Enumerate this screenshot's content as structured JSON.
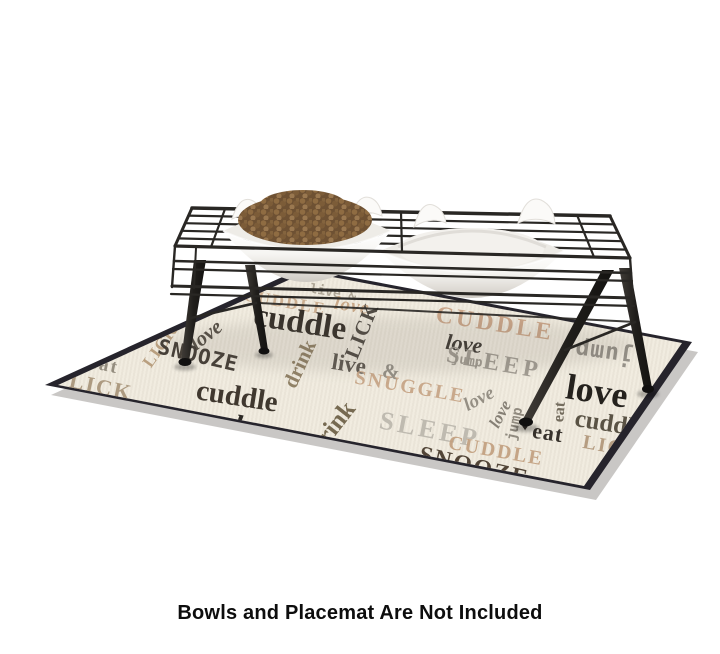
{
  "caption": "Bowls and Placemat Are Not Included",
  "stand": {
    "color": "#292724"
  },
  "bowls": {
    "color": "#f6f5f2",
    "kibble_color": "#7a5a38",
    "left_has_food": true,
    "right_empty": true
  },
  "mat": {
    "background": "#f1ece0",
    "border_color": "#26242c",
    "words": [
      {
        "t": "CUDDLE",
        "x": 285,
        "y": 302,
        "s": 17,
        "r": 10,
        "c": "#c9ab8b",
        "f": "serif",
        "ls": 2
      },
      {
        "t": "live &",
        "x": 333,
        "y": 293,
        "s": 13,
        "r": 10,
        "c": "#aaa292",
        "f": "mono",
        "ls": 0
      },
      {
        "t": "love",
        "x": 352,
        "y": 306,
        "s": 19,
        "r": 9,
        "c": "#c6a584",
        "f": "serif",
        "i": true,
        "ls": 1
      },
      {
        "t": "CUDDLE",
        "x": 495,
        "y": 324,
        "s": 24,
        "r": 9,
        "c": "#c9a284",
        "f": "serif",
        "ls": 3
      },
      {
        "t": "love",
        "x": 464,
        "y": 344,
        "s": 22,
        "r": 7,
        "c": "#35302a",
        "f": "serif",
        "i": true
      },
      {
        "t": "jump",
        "x": 467,
        "y": 361,
        "s": 13,
        "r": 9,
        "c": "#9c968c",
        "f": "mono"
      },
      {
        "t": "LICK",
        "x": 362,
        "y": 331,
        "s": 21,
        "r": -68,
        "c": "#46413a",
        "f": "serif",
        "ls": 1
      },
      {
        "t": "cuddle",
        "x": 300,
        "y": 323,
        "s": 33,
        "r": 9,
        "c": "#29231d",
        "f": "serif"
      },
      {
        "t": "love",
        "x": 206,
        "y": 335,
        "s": 21,
        "r": -38,
        "c": "#4c453c",
        "f": "serif",
        "i": true
      },
      {
        "t": "LICK",
        "x": 160,
        "y": 346,
        "s": 17,
        "r": -55,
        "c": "#b59a79",
        "f": "serif",
        "ls": 1
      },
      {
        "t": "SNOOZE",
        "x": 198,
        "y": 356,
        "s": 21,
        "r": 13,
        "c": "#3a332c",
        "f": "mono",
        "ls": 1
      },
      {
        "t": "eat",
        "x": 104,
        "y": 365,
        "s": 19,
        "r": 12,
        "c": "#8d8678",
        "f": "serif",
        "ls": 2
      },
      {
        "t": "LICK",
        "x": 101,
        "y": 387,
        "s": 22,
        "r": 12,
        "c": "#a8957a",
        "f": "serif",
        "ls": 2
      },
      {
        "t": "cuddle",
        "x": 237,
        "y": 397,
        "s": 29,
        "r": 9,
        "c": "#332b22",
        "f": "serif"
      },
      {
        "t": "drink",
        "x": 300,
        "y": 364,
        "s": 21,
        "r": -65,
        "c": "#8a7a5e",
        "f": "serif"
      },
      {
        "t": "live",
        "x": 349,
        "y": 364,
        "s": 23,
        "r": 9,
        "c": "#565048",
        "f": "serif"
      },
      {
        "t": "&",
        "x": 391,
        "y": 372,
        "s": 21,
        "r": 9,
        "c": "#8f8a80",
        "f": "serif"
      },
      {
        "t": "SNUGGLE",
        "x": 410,
        "y": 387,
        "s": 20,
        "r": 10,
        "c": "#c7a586",
        "f": "serif",
        "ls": 2
      },
      {
        "t": "SLEEP",
        "x": 494,
        "y": 363,
        "s": 24,
        "r": 10,
        "c": "#9d978d",
        "f": "serif",
        "ls": 4
      },
      {
        "t": "love",
        "x": 479,
        "y": 399,
        "s": 19,
        "r": -28,
        "c": "#8f897e",
        "f": "serif",
        "i": true
      },
      {
        "t": "love",
        "x": 500,
        "y": 414,
        "s": 17,
        "r": -62,
        "c": "#7e786d",
        "f": "serif",
        "i": true
      },
      {
        "t": "jump",
        "x": 515,
        "y": 424,
        "s": 14,
        "r": -78,
        "c": "#8a8478",
        "f": "mono"
      },
      {
        "t": "LICK",
        "x": 135,
        "y": 412,
        "s": 26,
        "r": 13,
        "c": "#474034",
        "f": "serif",
        "ls": 2
      },
      {
        "t": "♥",
        "x": 193,
        "y": 424,
        "s": 15,
        "r": 0,
        "c": "#221e1a",
        "f": "sans"
      },
      {
        "t": "love",
        "x": 258,
        "y": 430,
        "s": 30,
        "r": 10,
        "c": "#1e1a16",
        "f": "serif",
        "i": true
      },
      {
        "t": "drink",
        "x": 332,
        "y": 428,
        "s": 25,
        "r": -52,
        "c": "#6d6046",
        "f": "serif"
      },
      {
        "t": "SLEEP",
        "x": 430,
        "y": 430,
        "s": 26,
        "r": 11,
        "c": "#bcb7ad",
        "f": "serif",
        "ls": 4
      },
      {
        "t": "jump",
        "x": 604,
        "y": 352,
        "s": 23,
        "r": 188,
        "c": "#8f8a82",
        "f": "mono",
        "ls": 1
      },
      {
        "t": "love",
        "x": 597,
        "y": 391,
        "s": 36,
        "r": 9,
        "c": "#16130f",
        "f": "serif"
      },
      {
        "t": "cuddle",
        "x": 610,
        "y": 424,
        "s": 25,
        "r": 9,
        "c": "#4f4839",
        "f": "serif"
      },
      {
        "t": "LICK",
        "x": 612,
        "y": 447,
        "s": 20,
        "r": 10,
        "c": "#b1977a",
        "f": "serif",
        "ls": 2
      },
      {
        "t": "eat",
        "x": 560,
        "y": 412,
        "s": 16,
        "r": -85,
        "c": "#6b6354",
        "f": "serif"
      },
      {
        "t": "♥",
        "x": 525,
        "y": 428,
        "s": 11,
        "r": 0,
        "c": "#26211c",
        "f": "sans"
      },
      {
        "t": "eat",
        "x": 548,
        "y": 433,
        "s": 22,
        "r": 9,
        "c": "#2b251f",
        "f": "serif",
        "ls": 1
      },
      {
        "t": "CUDDLE",
        "x": 496,
        "y": 451,
        "s": 20,
        "r": 10,
        "c": "#c2a07f",
        "f": "serif",
        "ls": 2
      },
      {
        "t": "SNOOZE",
        "x": 474,
        "y": 467,
        "s": 24,
        "r": 13,
        "c": "#46392b",
        "f": "serif",
        "ls": 2
      }
    ]
  }
}
